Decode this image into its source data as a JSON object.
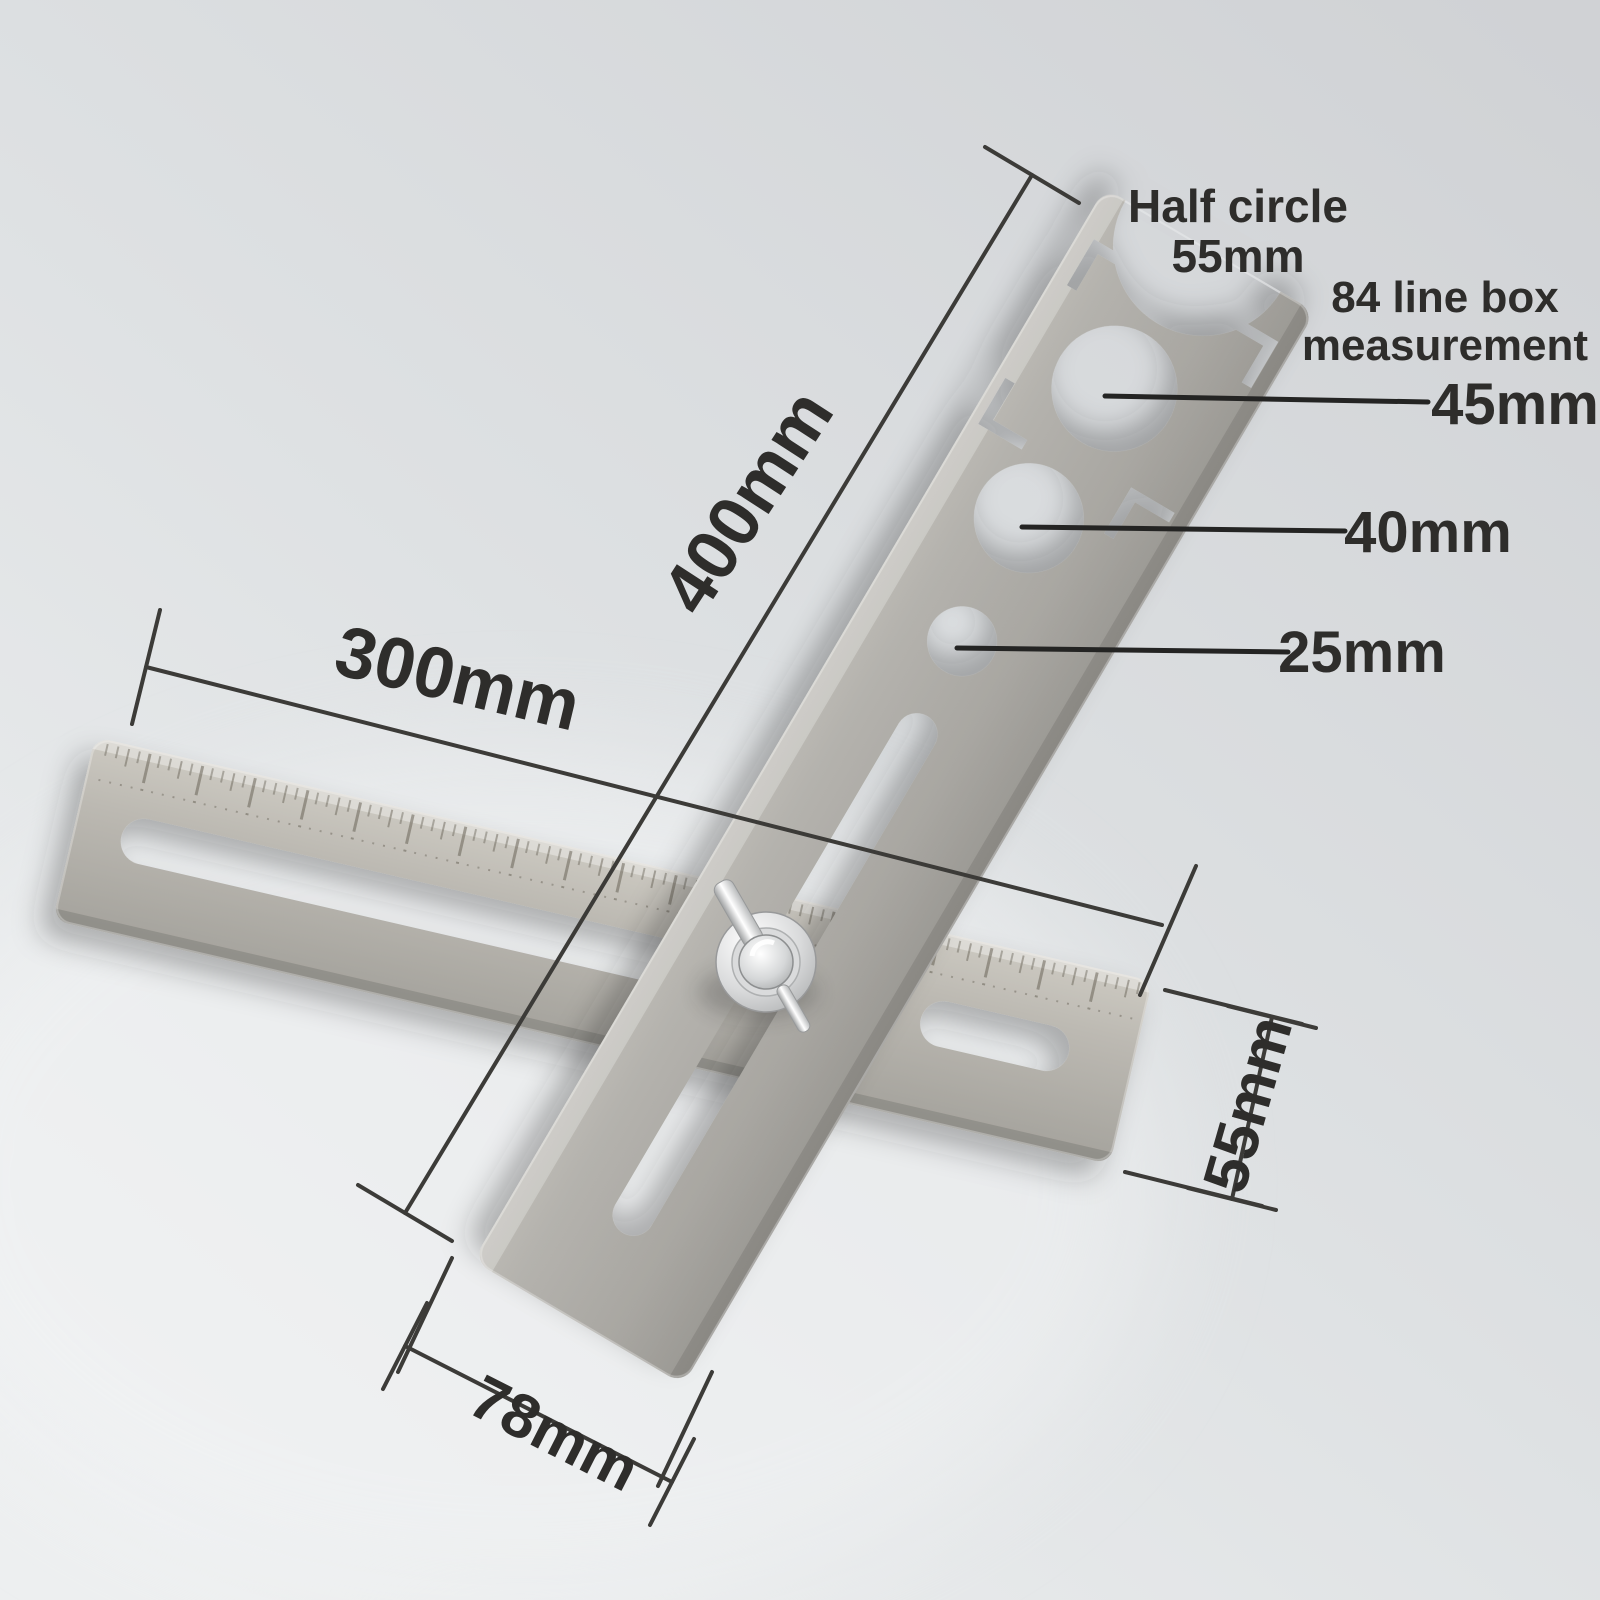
{
  "title": "Tile hole locator dimension diagram",
  "callouts": {
    "half_circle": {
      "title": "Half circle",
      "value": "55mm"
    },
    "line_box": {
      "title": "84 line box",
      "subtitle": "measurement"
    },
    "holes": [
      {
        "id": "hole-45mm",
        "label": "45mm"
      },
      {
        "id": "hole-40mm",
        "label": "40mm"
      },
      {
        "id": "hole-25mm",
        "label": "25mm"
      }
    ]
  },
  "dimensions": {
    "vertical_bar_length": "400mm",
    "horizontal_bar_length": "300mm",
    "horizontal_bar_width": "55mm",
    "vertical_bar_width": "78mm"
  },
  "colors": {
    "background_top": "#d2d4d7",
    "background_mid": "#dee0e2",
    "background_bottom": "#edeff0",
    "metal_light": "#c6c4bd",
    "metal_mid": "#a8a6a1",
    "metal_dark": "#8f8d89",
    "annotation_line": "#3c3b38",
    "text": "#2e2d2b",
    "bolt_chrome": "#f2f3f4"
  }
}
